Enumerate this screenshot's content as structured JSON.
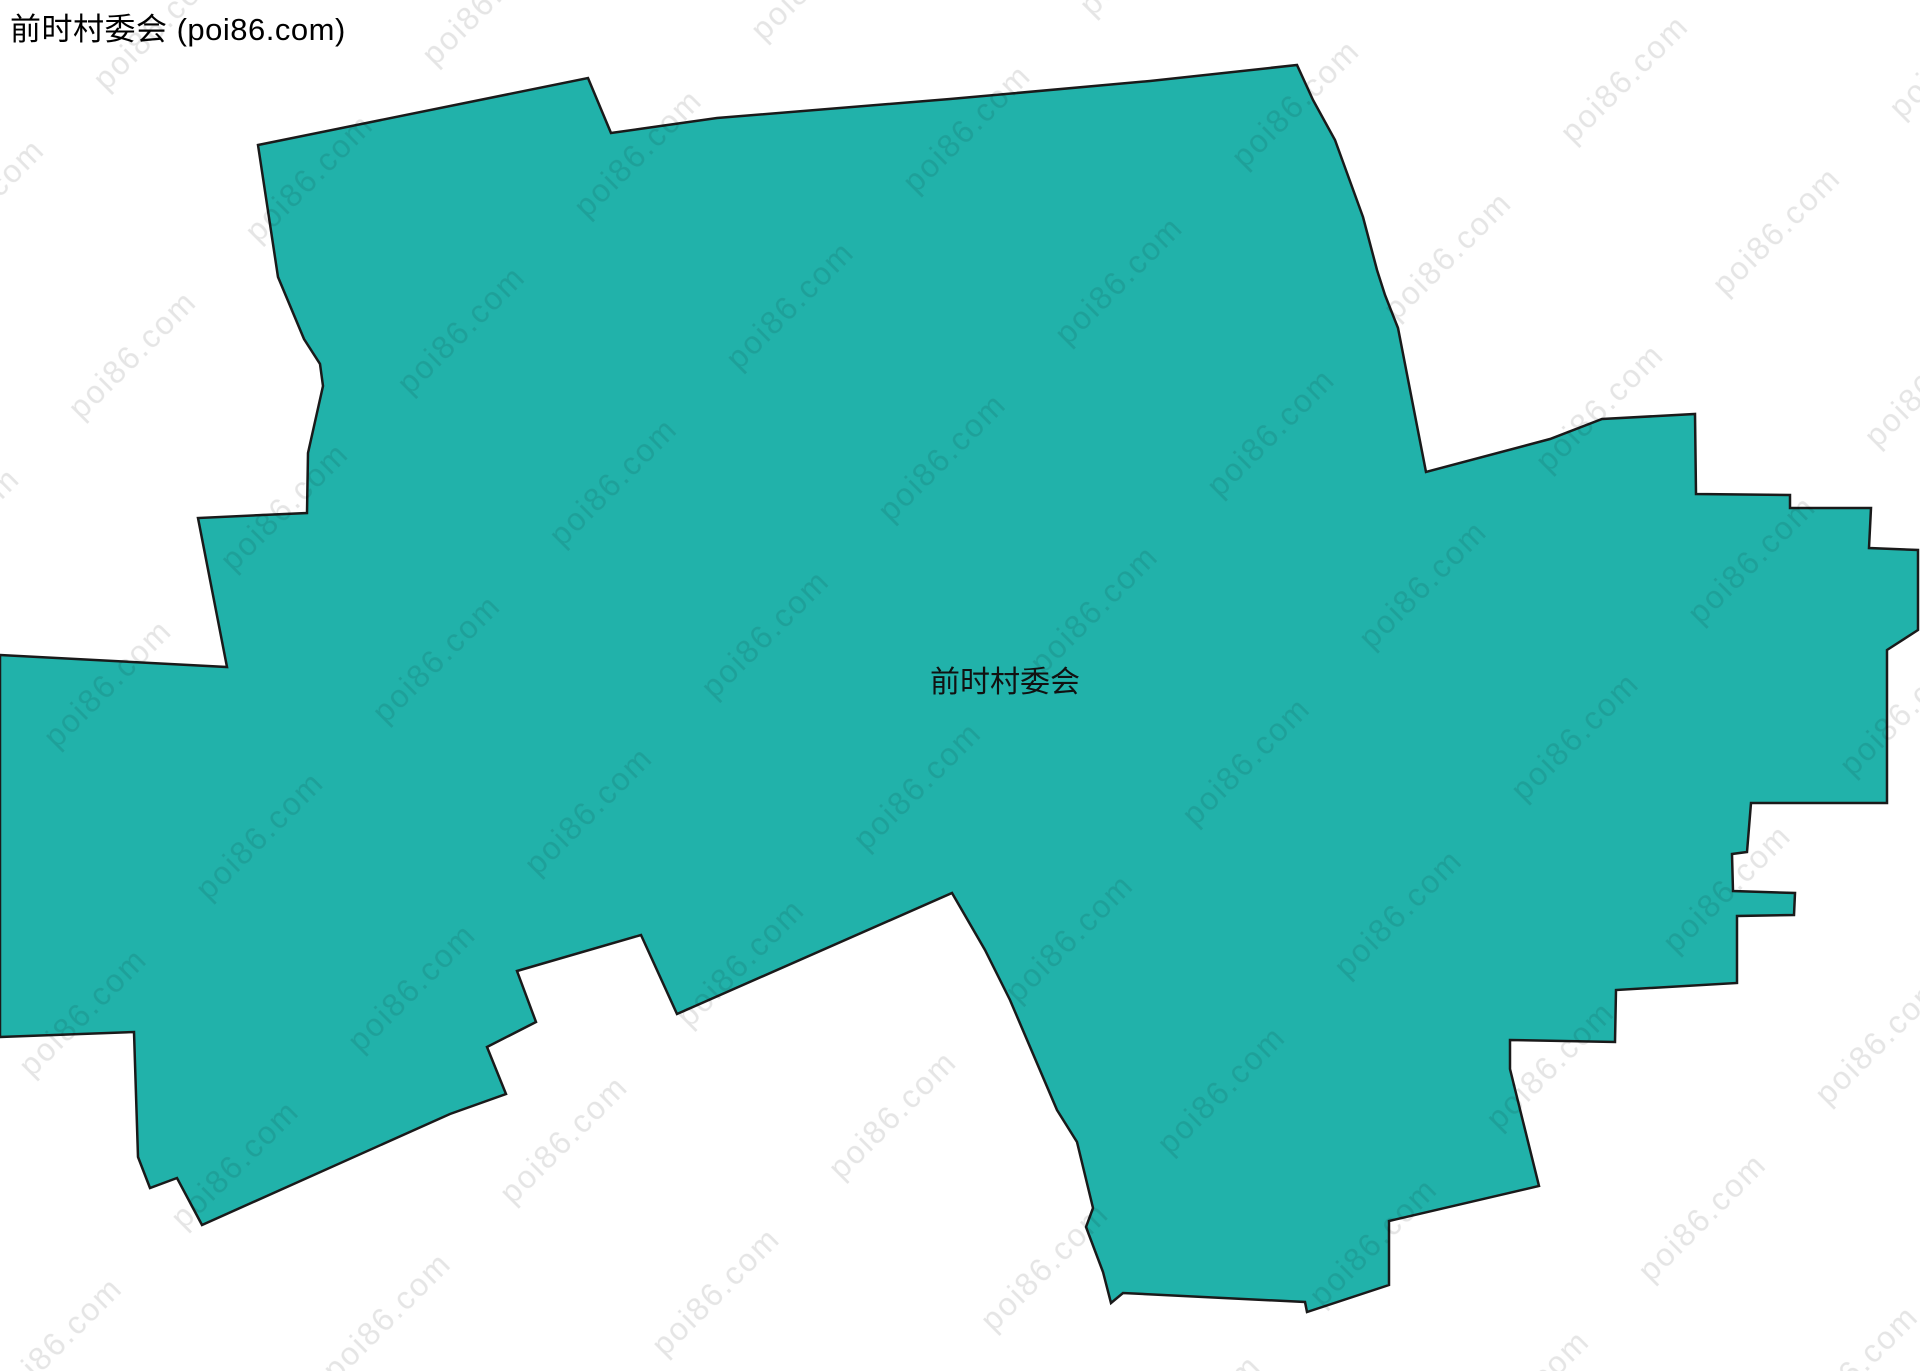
{
  "page": {
    "title": "前时村委会 (poi86.com)"
  },
  "map": {
    "canvas": {
      "width": 1920,
      "height": 1371,
      "background": "#ffffff"
    },
    "label": {
      "text": "前时村委会",
      "x": 1005,
      "y": 692,
      "font_size": 30,
      "color": "#111111"
    },
    "watermark": {
      "text": "poi86.com",
      "color": "#000000",
      "opacity": 0.1,
      "font_size": 32,
      "letter_spacing": 2,
      "tile_width": 250,
      "tile_height": 215,
      "angle": -45
    },
    "region": {
      "name": "前时村委会",
      "fill": "#21b2aa",
      "stroke": "#1a1a1a",
      "stroke_width": 2.5,
      "points": [
        [
          258,
          145
        ],
        [
          588,
          78
        ],
        [
          611,
          133
        ],
        [
          717,
          118
        ],
        [
          950,
          99
        ],
        [
          1150,
          81
        ],
        [
          1297,
          65
        ],
        [
          1313,
          100
        ],
        [
          1335,
          140
        ],
        [
          1363,
          217
        ],
        [
          1377,
          270
        ],
        [
          1385,
          295
        ],
        [
          1398,
          328
        ],
        [
          1426,
          472
        ],
        [
          1550,
          439
        ],
        [
          1602,
          419
        ],
        [
          1695,
          414
        ],
        [
          1696,
          494
        ],
        [
          1790,
          495
        ],
        [
          1790,
          508
        ],
        [
          1871,
          508
        ],
        [
          1869,
          548
        ],
        [
          1918,
          550
        ],
        [
          1918,
          630
        ],
        [
          1887,
          650
        ],
        [
          1887,
          803
        ],
        [
          1751,
          803
        ],
        [
          1747,
          852
        ],
        [
          1732,
          854
        ],
        [
          1733,
          891
        ],
        [
          1795,
          893
        ],
        [
          1794,
          915
        ],
        [
          1737,
          916
        ],
        [
          1737,
          983
        ],
        [
          1616,
          990
        ],
        [
          1615,
          1042
        ],
        [
          1510,
          1040
        ],
        [
          1510,
          1069
        ],
        [
          1539,
          1186
        ],
        [
          1389,
          1221
        ],
        [
          1389,
          1285
        ],
        [
          1307,
          1312
        ],
        [
          1305,
          1302
        ],
        [
          1123,
          1293
        ],
        [
          1111,
          1303
        ],
        [
          1103,
          1272
        ],
        [
          1086,
          1227
        ],
        [
          1093,
          1208
        ],
        [
          1077,
          1142
        ],
        [
          1057,
          1110
        ],
        [
          1010,
          1000
        ],
        [
          985,
          950
        ],
        [
          952,
          893
        ],
        [
          677,
          1014
        ],
        [
          641,
          935
        ],
        [
          517,
          971
        ],
        [
          536,
          1022
        ],
        [
          487,
          1047
        ],
        [
          506,
          1094
        ],
        [
          450,
          1114
        ],
        [
          202,
          1225
        ],
        [
          177,
          1178
        ],
        [
          150,
          1188
        ],
        [
          138,
          1157
        ],
        [
          134,
          1032
        ],
        [
          0,
          1037
        ],
        [
          0,
          655
        ],
        [
          227,
          667
        ],
        [
          198,
          518
        ],
        [
          307,
          513
        ],
        [
          308,
          453
        ],
        [
          323,
          386
        ],
        [
          320,
          364
        ],
        [
          304,
          339
        ],
        [
          278,
          277
        ]
      ]
    }
  }
}
